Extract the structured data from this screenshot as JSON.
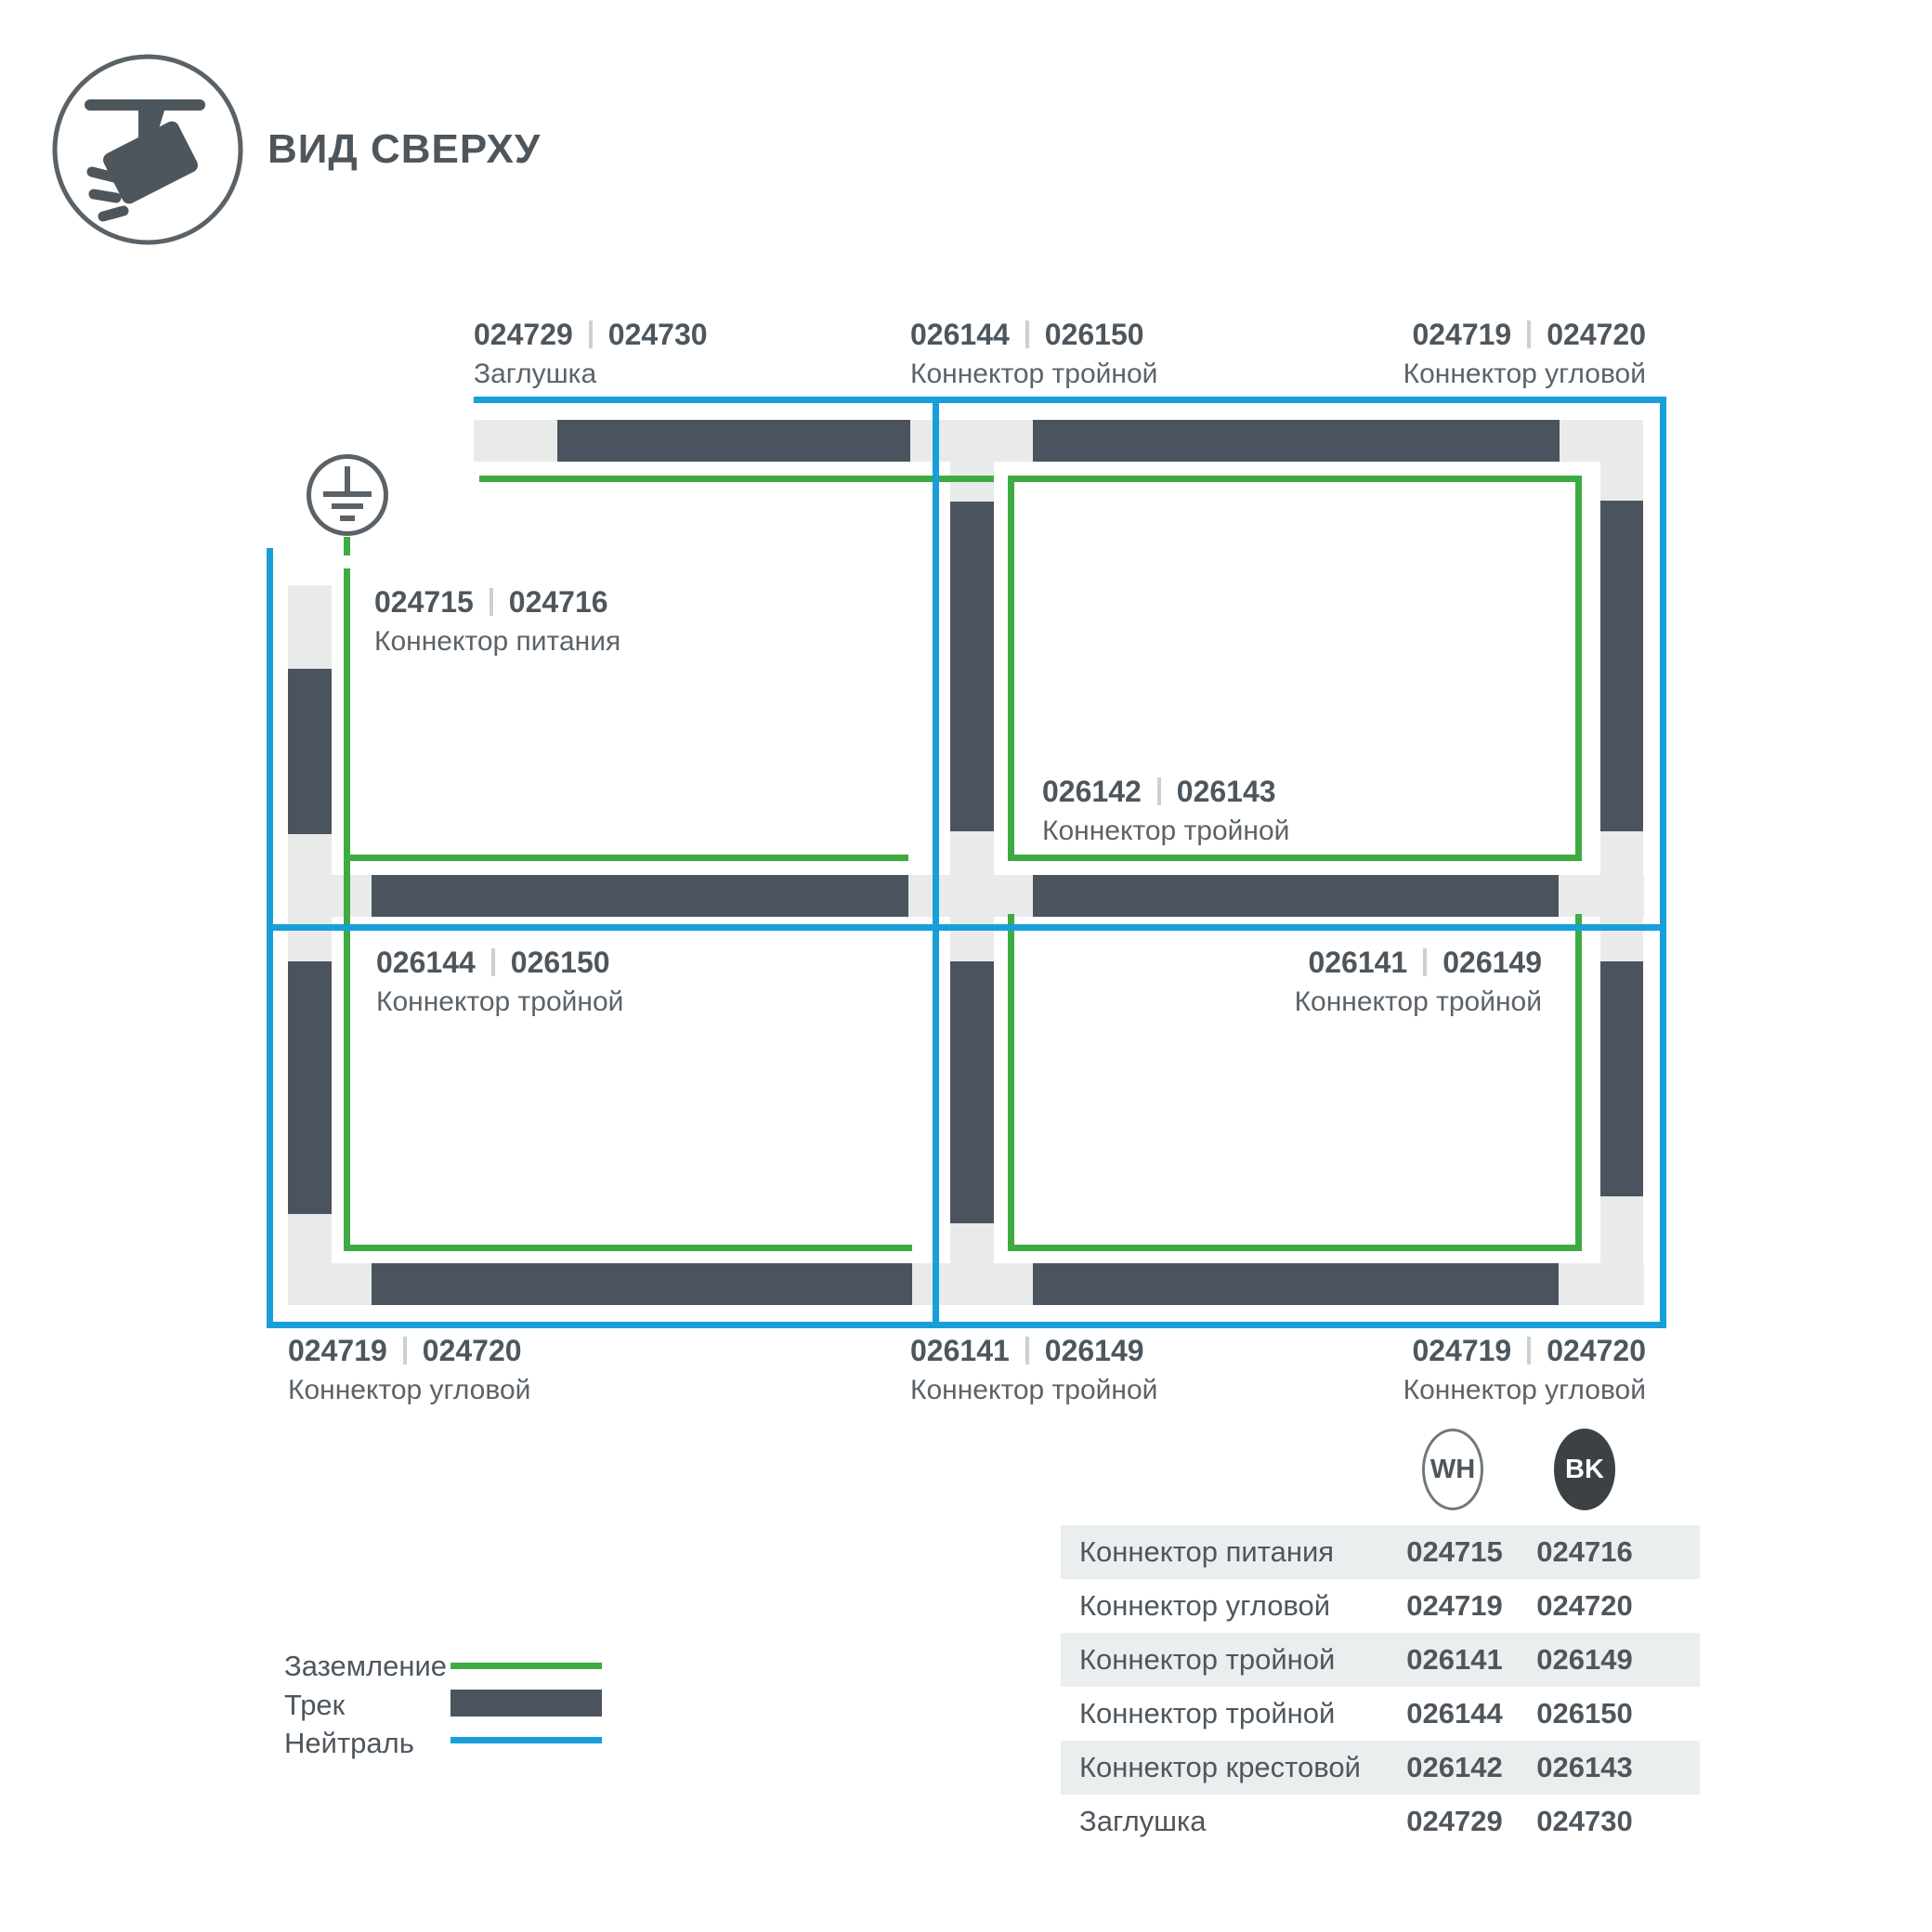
{
  "title": "ВИД СВЕРХУ",
  "colors": {
    "ground_green": "#3eab42",
    "neutral_blue": "#189fd9",
    "track_dark": "#4b545e",
    "connector_light": "#e9ebeb",
    "text_dark": "#4e565d",
    "badge_bk_bg": "#3b4145",
    "table_row_gray": "#ebeeee"
  },
  "diagram": {
    "ground_symbol": "earth-ground-icon",
    "labels": [
      {
        "code_wh": "024729",
        "code_bk": "024730",
        "name": "Заглушка"
      },
      {
        "code_wh": "026144",
        "code_bk": "026150",
        "name": "Коннектор тройной"
      },
      {
        "code_wh": "024719",
        "code_bk": "024720",
        "name": "Коннектор угловой"
      },
      {
        "code_wh": "024715",
        "code_bk": "024716",
        "name": "Коннектор питания"
      },
      {
        "code_wh": "026142",
        "code_bk": "026143",
        "name": "Коннектор тройной"
      },
      {
        "code_wh": "026144",
        "code_bk": "026150",
        "name": "Коннектор тройной"
      },
      {
        "code_wh": "026141",
        "code_bk": "026149",
        "name": "Коннектор тройной"
      },
      {
        "code_wh": "024719",
        "code_bk": "024720",
        "name": "Коннектор угловой"
      },
      {
        "code_wh": "026141",
        "code_bk": "026149",
        "name": "Коннектор тройной"
      },
      {
        "code_wh": "024719",
        "code_bk": "024720",
        "name": "Коннектор угловой"
      }
    ]
  },
  "legend": {
    "items": [
      {
        "label": "Заземление",
        "swatch": "ground-line"
      },
      {
        "label": "Трек",
        "swatch": "track-bar"
      },
      {
        "label": "Нейтраль",
        "swatch": "neutral-line"
      }
    ]
  },
  "swatch_table": {
    "columns": {
      "wh": "WH",
      "bk": "BK"
    },
    "rows": [
      {
        "name": "Коннектор питания",
        "wh": "024715",
        "bk": "024716"
      },
      {
        "name": "Коннектор угловой",
        "wh": "024719",
        "bk": "024720"
      },
      {
        "name": "Коннектор тройной",
        "wh": "026141",
        "bk": "026149"
      },
      {
        "name": "Коннектор тройной",
        "wh": "026144",
        "bk": "026150"
      },
      {
        "name": "Коннектор крестовой",
        "wh": "026142",
        "bk": "026143"
      },
      {
        "name": "Заглушка",
        "wh": "024729",
        "bk": "024730"
      }
    ]
  }
}
